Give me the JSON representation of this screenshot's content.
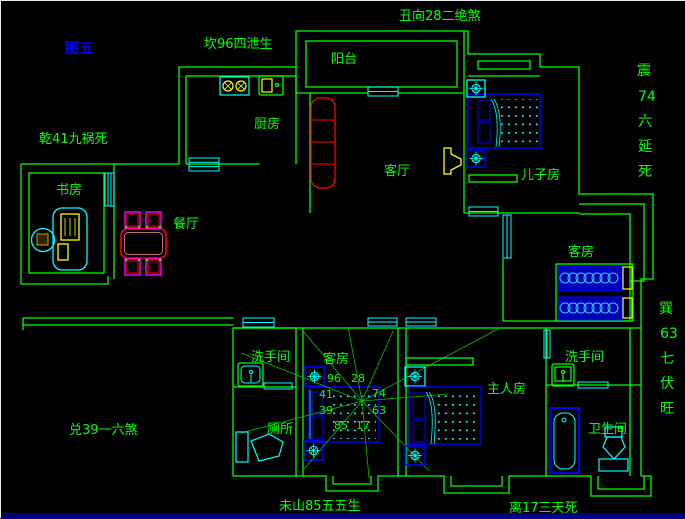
{
  "figure_label": "图五",
  "annotations": {
    "north": "坎96四泄生",
    "northeast": "丑向28二绝煞",
    "northwest": "乾41九祸死",
    "west": "兑39一六煞",
    "southwest": "未山85五五生",
    "south": "离17三天死",
    "east_vertical": [
      "震",
      "74",
      "六",
      "延",
      "死"
    ],
    "southeast_vertical": [
      "巽",
      "63",
      "七",
      "伏",
      "旺"
    ]
  },
  "rooms": {
    "balcony": "阳台",
    "kitchen": "厨房",
    "living": "客厅",
    "son_room": "儿子房",
    "study": "书房",
    "dining": "餐厅",
    "guest_room_right": "客房",
    "guest_room_mid": "客房",
    "washroom_left": "洗手间",
    "toilet_left": "厕所",
    "master_room": "主人房",
    "washroom_right": "洗手间",
    "bathroom_right": "卫生间"
  },
  "compass": {
    "numbers": [
      "96",
      "28",
      "41",
      "74",
      "39",
      "63",
      "85",
      "17"
    ]
  },
  "colors": {
    "wall": "#00ff00",
    "window": "#00ffff",
    "furniture": "#0000ff",
    "accent_yellow": "#ffff00",
    "accent_red": "#ff0000",
    "accent_magenta": "#ff00ff",
    "label": "#00ff00",
    "figure_label": "#0000ff",
    "taskbar": "#000080"
  }
}
